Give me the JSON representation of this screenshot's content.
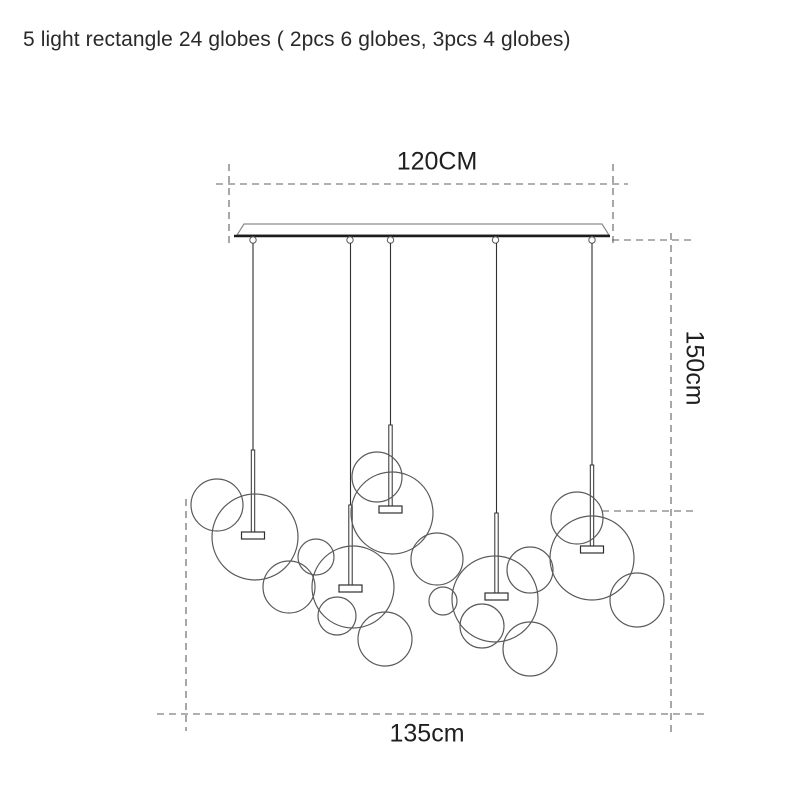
{
  "title": "5 light rectangle 24 globes ( 2pcs 6 globes, 3pcs 4 globes)",
  "dimensions": {
    "width": "120CM",
    "drop": "150cm",
    "spread": "135cm"
  },
  "colors": {
    "background": "#ffffff",
    "outline": "#5a5a5a",
    "cord": "#2f2f2f",
    "canopy_edge": "#8a8a8a",
    "canopy_base": "#1c1c1c",
    "dashed": "#5f5f5f",
    "text": "#1f1f1f"
  },
  "diagram": {
    "canopy": {
      "polygon": "244,224 602,224 609,235 237,235",
      "base": [
        234,
        236,
        610,
        236
      ],
      "hanger_xs": [
        253,
        350,
        390.5,
        495.5,
        592
      ],
      "hanger_y": 240,
      "hanger_r": 3.2
    },
    "cap": {
      "width": 23,
      "height": 7,
      "rod_width": 3.4
    },
    "cords": [
      {
        "x": 253,
        "wire_top": 243,
        "rod_top": 450,
        "cap_top": 532
      },
      {
        "x": 350.5,
        "wire_top": 243,
        "rod_top": 505,
        "cap_top": 585
      },
      {
        "x": 390.5,
        "wire_top": 243,
        "rod_top": 425,
        "cap_top": 506
      },
      {
        "x": 496.5,
        "wire_top": 243,
        "rod_top": 513,
        "cap_top": 593
      },
      {
        "x": 592,
        "wire_top": 243,
        "rod_top": 465,
        "cap_top": 546
      }
    ],
    "globes": [
      [
        217,
        505,
        26
      ],
      [
        255,
        537,
        43
      ],
      [
        289,
        587,
        26
      ],
      [
        316,
        557,
        18
      ],
      [
        353,
        587,
        41
      ],
      [
        337,
        616,
        19
      ],
      [
        385,
        639,
        27
      ],
      [
        377,
        477,
        25
      ],
      [
        392,
        513,
        41
      ],
      [
        437,
        559,
        26
      ],
      [
        443,
        601,
        14
      ],
      [
        495,
        599,
        43
      ],
      [
        482,
        626,
        22
      ],
      [
        530,
        649,
        27
      ],
      [
        530,
        570,
        23
      ],
      [
        577,
        518,
        26
      ],
      [
        592,
        558,
        42
      ],
      [
        637,
        600,
        27
      ]
    ],
    "dashed_lines": [
      {
        "name": "dim-width-line",
        "x1": 216,
        "y1": 184,
        "x2": 628,
        "y2": 184
      },
      {
        "name": "dim-width-ext-left",
        "x1": 229,
        "y1": 164,
        "x2": 229,
        "y2": 247
      },
      {
        "name": "dim-width-ext-right",
        "x1": 613,
        "y1": 164,
        "x2": 613,
        "y2": 247
      },
      {
        "name": "dim-drop-line",
        "x1": 671,
        "y1": 233,
        "x2": 671,
        "y2": 737
      },
      {
        "name": "dim-drop-ext-top",
        "x1": 612,
        "y1": 240,
        "x2": 694,
        "y2": 240
      },
      {
        "name": "dim-drop-ext-bottom",
        "x1": 602,
        "y1": 511,
        "x2": 694,
        "y2": 511
      },
      {
        "name": "dim-spread-line",
        "x1": 157,
        "y1": 714,
        "x2": 706,
        "y2": 714
      },
      {
        "name": "dim-spread-ext-left",
        "x1": 186,
        "y1": 499,
        "x2": 186,
        "y2": 731
      }
    ]
  }
}
